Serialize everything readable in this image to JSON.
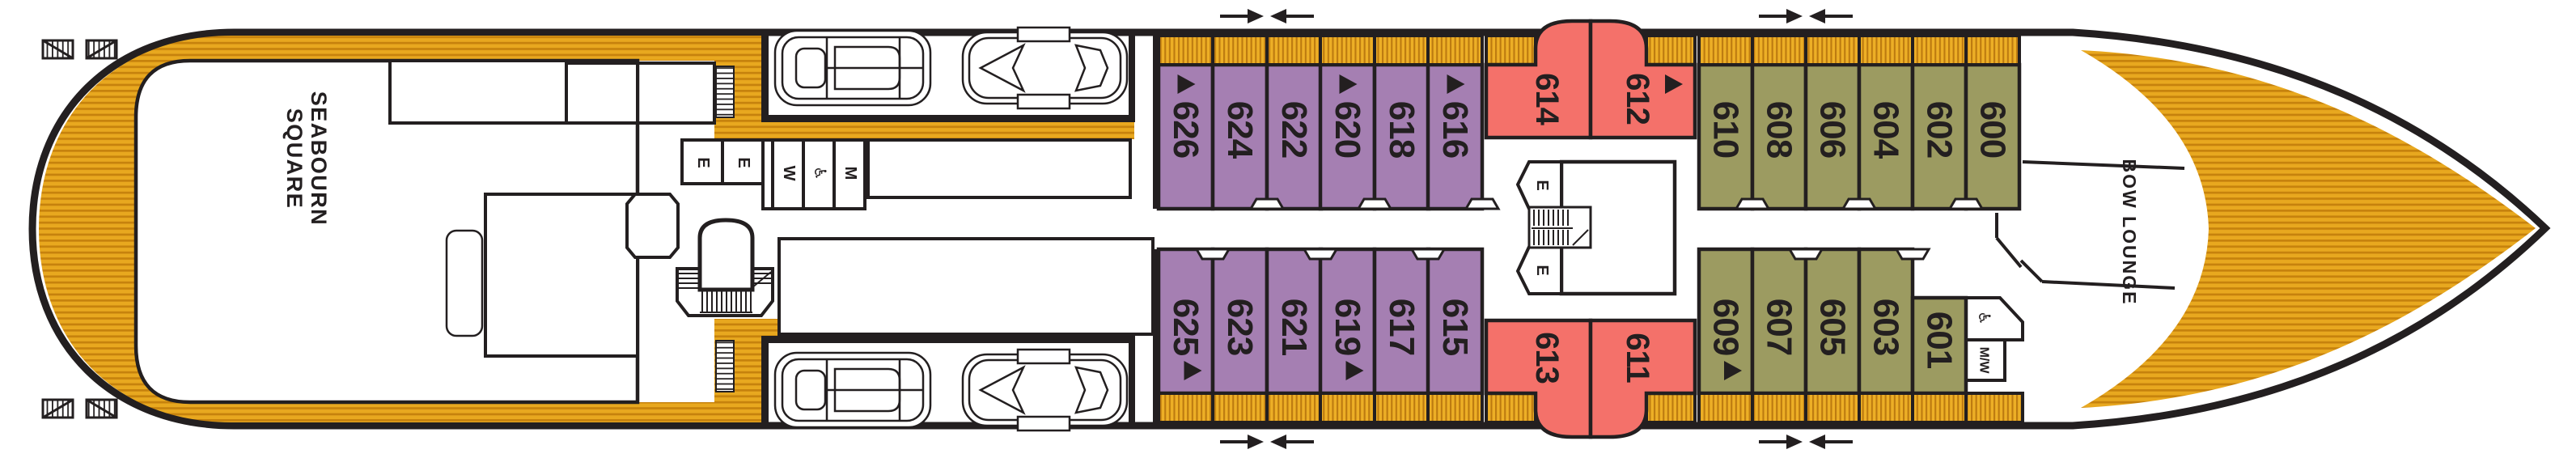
{
  "plan": {
    "ship_part_left": "stern",
    "ship_part_right": "bow",
    "areas": {
      "stern_lounge_line1": "SEABOURN",
      "stern_lounge_line2": "SQUARE",
      "bow_lounge": "BOW LOUNGE"
    },
    "facilities": {
      "elevator_label": "E",
      "women_label": "W",
      "men_label": "M",
      "accessible_label": "♿",
      "mens_womens_label": "M/W"
    },
    "colors": {
      "ink": "#231F20",
      "deck_gold": "#E8A81F",
      "deck_gold_dark": "#C6820D",
      "cabin_purple": "#A57FB2",
      "cabin_red": "#F4716A",
      "cabin_olive": "#9C9B61",
      "white": "#FFFFFF"
    },
    "cabins": {
      "port_row": [
        {
          "number": "626",
          "category": "purple",
          "marker": true
        },
        {
          "number": "624",
          "category": "purple",
          "marker": false
        },
        {
          "number": "622",
          "category": "purple",
          "marker": false
        },
        {
          "number": "620",
          "category": "purple",
          "marker": true
        },
        {
          "number": "618",
          "category": "purple",
          "marker": false
        },
        {
          "number": "616",
          "category": "purple",
          "marker": true
        },
        {
          "number": "614",
          "category": "red",
          "marker": false
        },
        {
          "number": "612",
          "category": "red",
          "marker": true
        },
        {
          "number": "610",
          "category": "olive",
          "marker": false
        },
        {
          "number": "608",
          "category": "olive",
          "marker": false
        },
        {
          "number": "606",
          "category": "olive",
          "marker": false
        },
        {
          "number": "604",
          "category": "olive",
          "marker": false
        },
        {
          "number": "602",
          "category": "olive",
          "marker": false
        },
        {
          "number": "600",
          "category": "olive",
          "marker": false
        }
      ],
      "starboard_row": [
        {
          "number": "625",
          "category": "purple",
          "marker": true
        },
        {
          "number": "623",
          "category": "purple",
          "marker": false
        },
        {
          "number": "621",
          "category": "purple",
          "marker": false
        },
        {
          "number": "619",
          "category": "purple",
          "marker": true
        },
        {
          "number": "617",
          "category": "purple",
          "marker": false
        },
        {
          "number": "615",
          "category": "purple",
          "marker": false
        },
        {
          "number": "613",
          "category": "red",
          "marker": false
        },
        {
          "number": "611",
          "category": "red",
          "marker": false
        },
        {
          "number": "609",
          "category": "olive",
          "marker": true
        },
        {
          "number": "607",
          "category": "olive",
          "marker": false
        },
        {
          "number": "605",
          "category": "olive",
          "marker": false
        },
        {
          "number": "603",
          "category": "olive",
          "marker": false
        },
        {
          "number": "601",
          "category": "olive",
          "marker": false
        }
      ]
    }
  }
}
